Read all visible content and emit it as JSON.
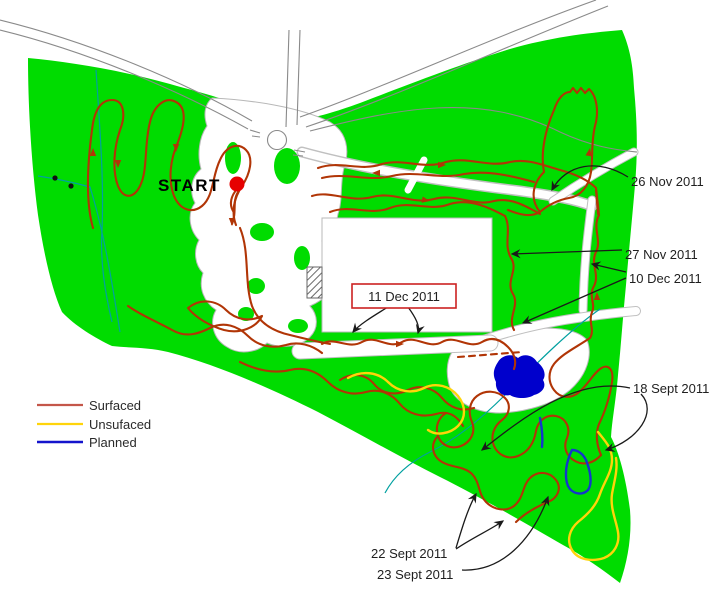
{
  "map": {
    "start": {
      "label": "START"
    },
    "legend": {
      "items": [
        {
          "label": "Surfaced",
          "color": "#c4564a"
        },
        {
          "label": "Unsufaced",
          "color": "#ffd40a"
        },
        {
          "label": "Planned",
          "color": "#1414cc"
        }
      ]
    },
    "annotations": {
      "nov26": {
        "label": "26 Nov 2011"
      },
      "nov27": {
        "label": "27 Nov 2011"
      },
      "dec10": {
        "label": "10 Dec 2011"
      },
      "dec11": {
        "label": "11 Dec 2011"
      },
      "sept18": {
        "label": "18 Sept 2011"
      },
      "sept22": {
        "label": "22 Sept 2011"
      },
      "sept23": {
        "label": "23 Sept 2011"
      }
    }
  },
  "colors": {
    "park_green": "#00dc00",
    "trail_surfaced": "#b13506",
    "trail_unsurfaced": "#ffd40a",
    "trail_planned": "#1437cc",
    "pond_blue": "#0000cc",
    "stream_teal": "#00a0a0",
    "road_gray": "#8a8a8a",
    "box_red": "#cc2222",
    "start_dot": "#e60000"
  }
}
